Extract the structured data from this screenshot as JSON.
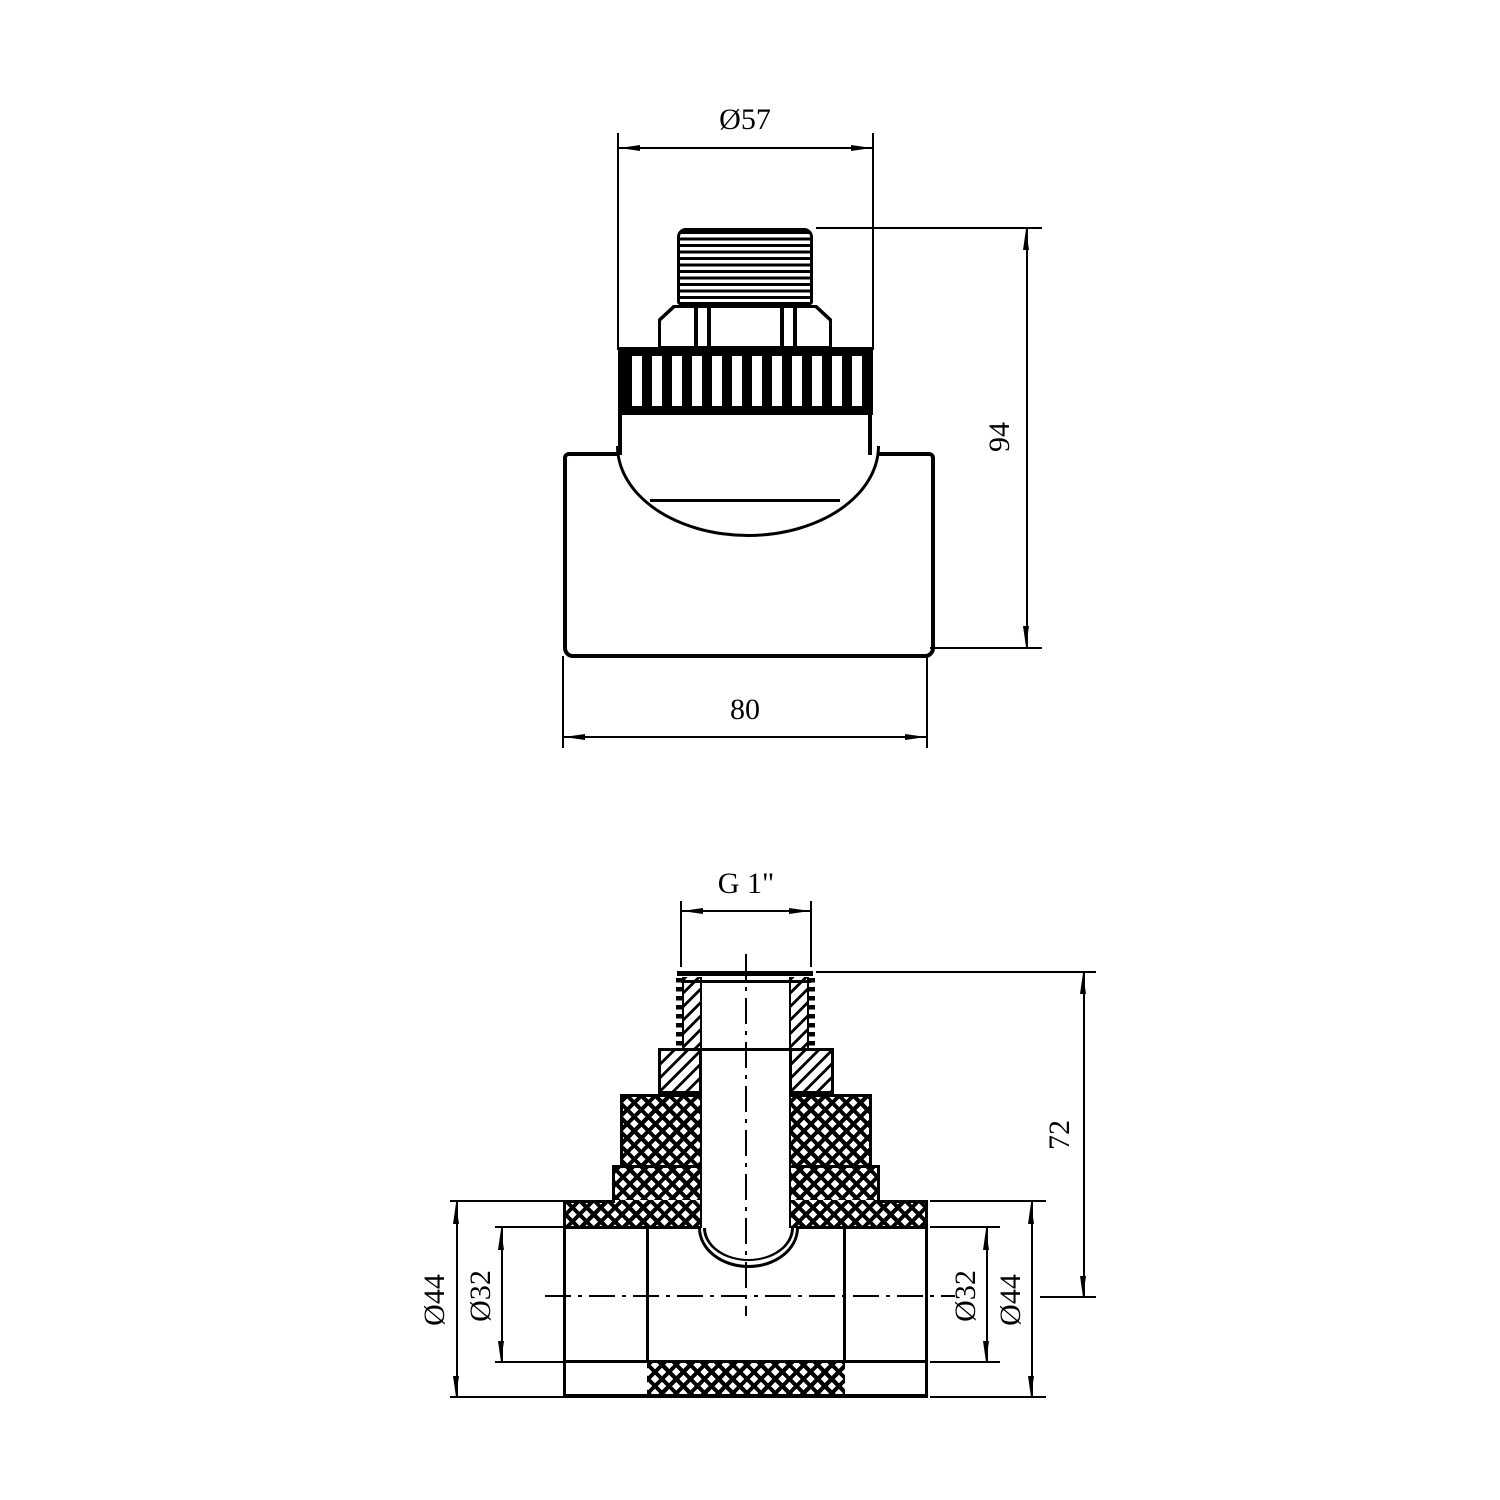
{
  "meta": {
    "background": "#ffffff",
    "ink": "#000000",
    "description": "Technical drawing, PPR tee fitting with male thread, two orthographic views"
  },
  "front_view": {
    "name": "front view",
    "dims": {
      "width_top": "Ø57",
      "height": "94",
      "width_bottom": "80"
    }
  },
  "section_view": {
    "name": "section view",
    "dims": {
      "thread": "G 1\"",
      "height": "72",
      "left_outer": "Ø44",
      "left_inner": "Ø32",
      "right_inner": "Ø32",
      "right_outer": "Ø44"
    }
  }
}
